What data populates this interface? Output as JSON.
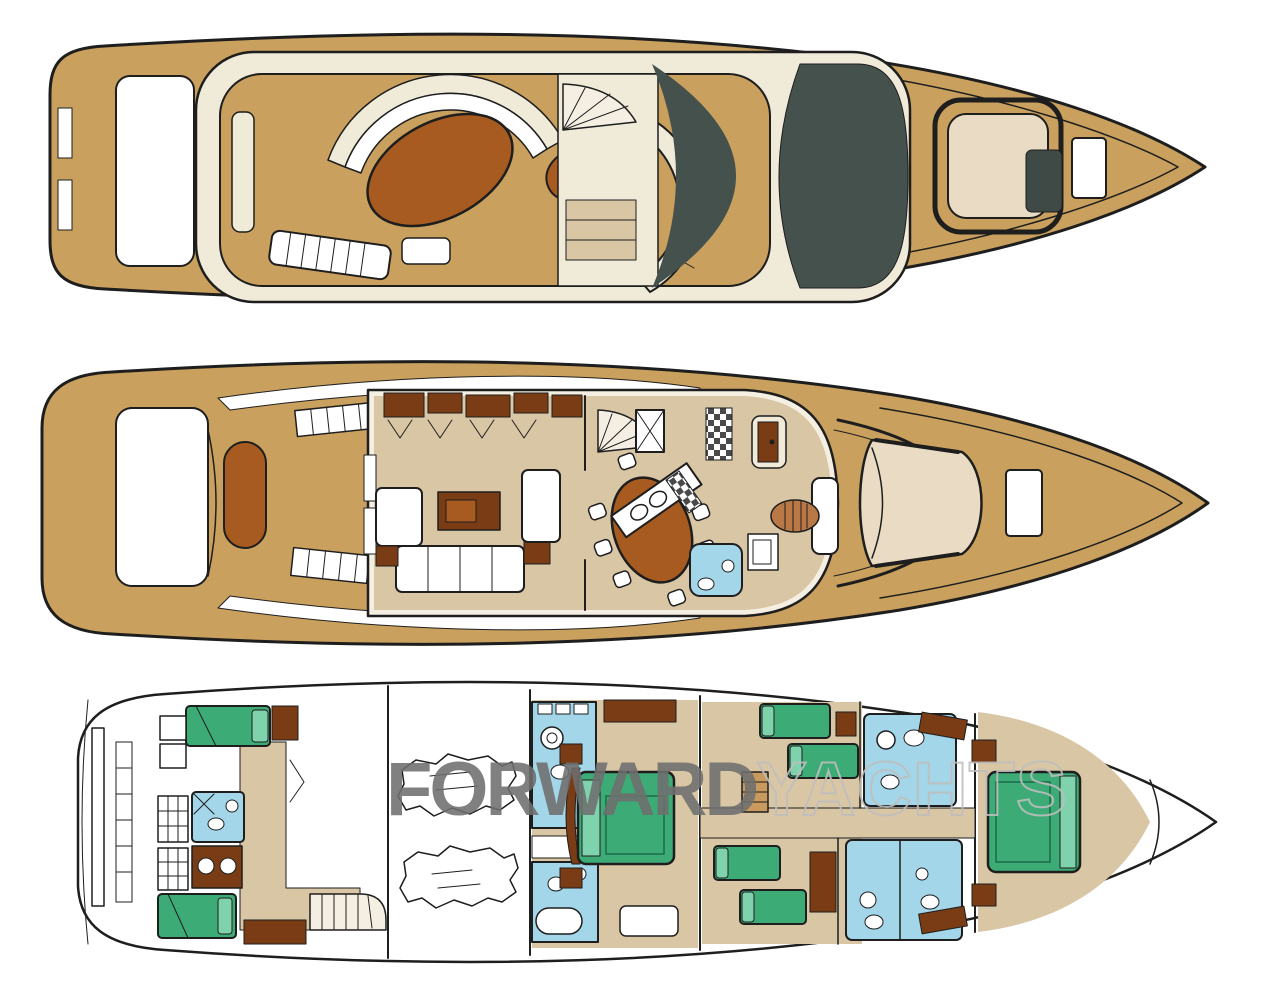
{
  "watermark": {
    "primary": "FORWARD",
    "secondary": "YACHTS"
  },
  "colors": {
    "hull_line": "#1e1e1e",
    "deck_tan": "#c9a05e",
    "cream": "#f0ead9",
    "sunroof_slate": "#45514d",
    "floor_beige": "#d9c6a5",
    "table_brown": "#a85b20",
    "wood_dark": "#7a3c14",
    "bed_green": "#3dab76",
    "bed_green_light": "#7ed2ac",
    "bath_blue": "#a3d6e8",
    "watermark_bold": "#6f6f6f",
    "watermark_light": "#bfbfbf"
  }
}
